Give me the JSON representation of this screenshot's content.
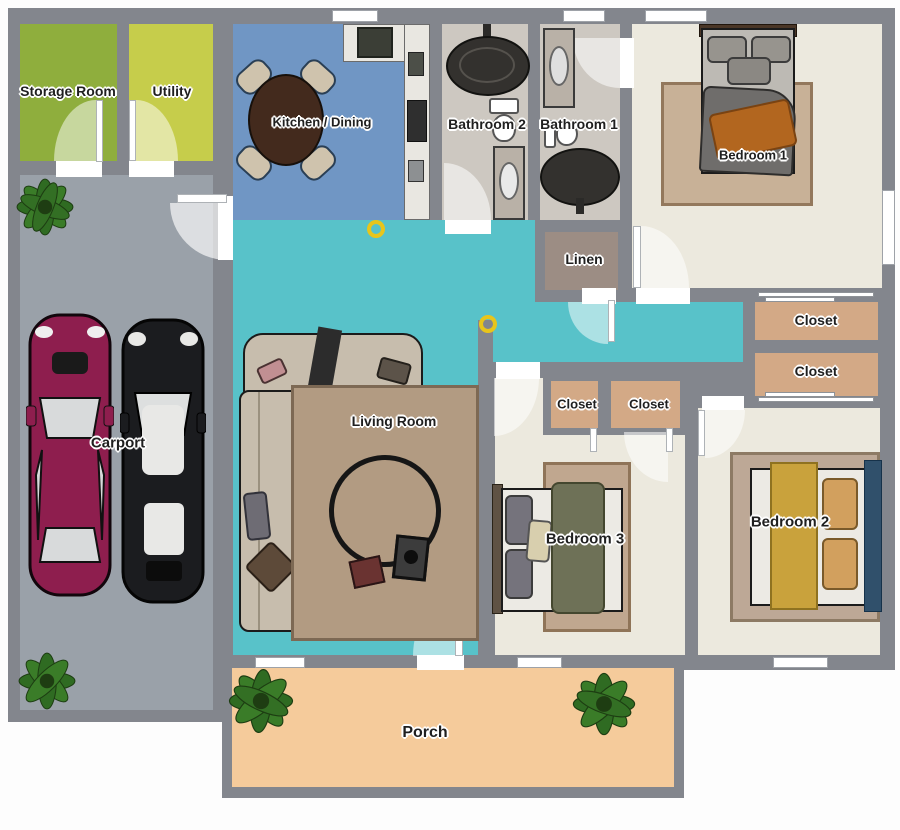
{
  "title": "House floor plan",
  "colors": {
    "wall": "#83868d",
    "storage_floor": "#8fae3d",
    "utility_floor": "#c6cd4b",
    "carport_floor": "#9aa1a9",
    "kitchen_floor": "#7096c4",
    "bathroom_floor": "#cdc8c1",
    "bedroom_floor": "#ece9de",
    "hallway_floor": "#58c2c9",
    "closet_floor": "#d3a986",
    "linen_floor": "#9c8d84",
    "porch_floor": "#f5cb9b",
    "accent_yellow": "#e8c51b",
    "car_maroon": "#8e1e4e",
    "car_black": "#1b1c1f",
    "plant_green": "#2f6b22"
  },
  "rooms": {
    "storage": {
      "label": "Storage Room"
    },
    "utility": {
      "label": "Utility"
    },
    "kitchen": {
      "label": "Kitchen / Dining"
    },
    "bathroom2": {
      "label": "Bathroom 2"
    },
    "bathroom1": {
      "label": "Bathroom 1"
    },
    "bedroom1": {
      "label": "Bedroom 1"
    },
    "linen": {
      "label": "Linen"
    },
    "closet_hall_top": {
      "label": "Closet"
    },
    "closet_hall_bottom": {
      "label": "Closet"
    },
    "closet_bed3_left": {
      "label": "Closet"
    },
    "closet_bed3_right": {
      "label": "Closet"
    },
    "carport": {
      "label": "Carport"
    },
    "living": {
      "label": "Living Room"
    },
    "bedroom3": {
      "label": "Bedroom 3"
    },
    "bedroom2": {
      "label": "Bedroom 2"
    },
    "porch": {
      "label": "Porch"
    }
  }
}
